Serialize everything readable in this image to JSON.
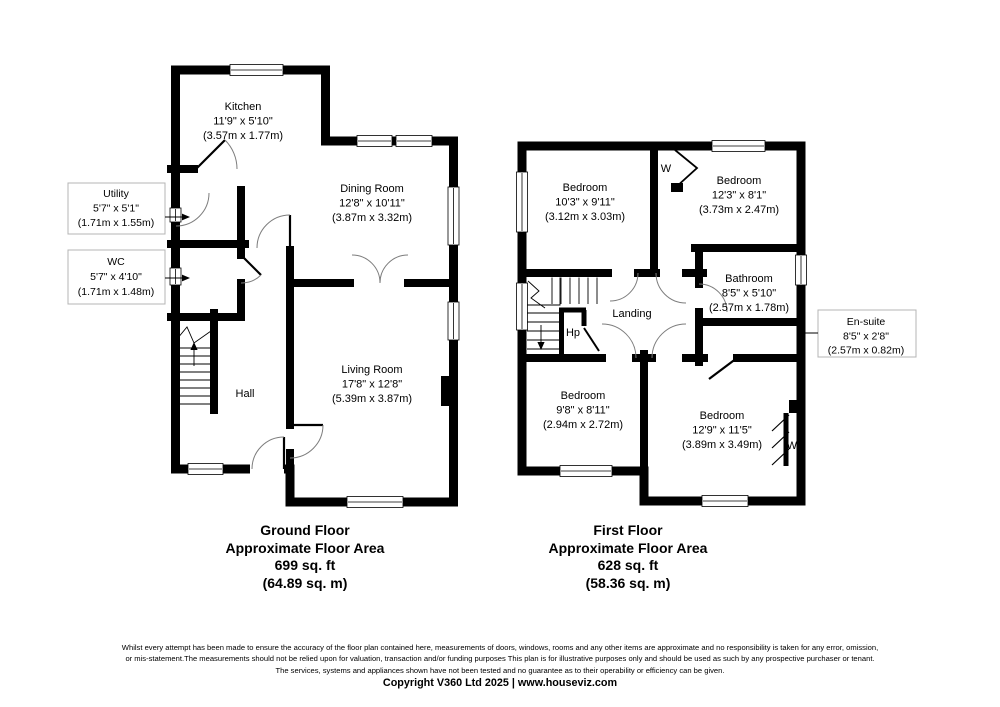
{
  "colors": {
    "wall": "#000000",
    "text": "#000000",
    "door_arc": "#7d7d7d",
    "callout_border": "#b4b4b4",
    "background": "#ffffff"
  },
  "ground_floor": {
    "rooms": {
      "kitchen": {
        "name": "Kitchen",
        "imperial": "11'9\" x 5'10\"",
        "metric": "(3.57m x 1.77m)"
      },
      "dining_room": {
        "name": "Dining Room",
        "imperial": "12'8\" x 10'11\"",
        "metric": "(3.87m x 3.32m)"
      },
      "living_room": {
        "name": "Living Room",
        "imperial": "17'8\" x 12'8\"",
        "metric": "(5.39m x 3.87m)"
      },
      "hall": {
        "name": "Hall"
      },
      "utility": {
        "name": "Utility",
        "imperial": "5'7\" x 5'1\"",
        "metric": "(1.71m x 1.55m)"
      },
      "wc": {
        "name": "WC",
        "imperial": "5'7\" x 4'10\"",
        "metric": "(1.71m x 1.48m)"
      }
    },
    "summary": {
      "title": "Ground Floor",
      "subtitle": "Approximate Floor Area",
      "area_imperial": "699 sq. ft",
      "area_metric": "(64.89 sq. m)"
    }
  },
  "first_floor": {
    "rooms": {
      "bedroom_1": {
        "name": "Bedroom",
        "imperial": "10'3\" x 9'11\"",
        "metric": "(3.12m x 3.03m)"
      },
      "bedroom_2": {
        "name": "Bedroom",
        "imperial": "12'3\" x 8'1\"",
        "metric": "(3.73m x 2.47m)"
      },
      "bathroom": {
        "name": "Bathroom",
        "imperial": "8'5\" x 5'10\"",
        "metric": "(2.57m x 1.78m)"
      },
      "en_suite": {
        "name": "En-suite",
        "imperial": "8'5\" x 2'8\"",
        "metric": "(2.57m x 0.82m)"
      },
      "landing": {
        "name": "Landing"
      },
      "hp": {
        "name": "Hp"
      },
      "bedroom_3": {
        "name": "Bedroom",
        "imperial": "9'8\" x 8'11\"",
        "metric": "(2.94m x 2.72m)"
      },
      "bedroom_4": {
        "name": "Bedroom",
        "imperial": "12'9\" x 11'5\"",
        "metric": "(3.89m x 3.49m)"
      },
      "wardrobe_top": {
        "name": "W"
      },
      "wardrobe_bottom": {
        "name": "W"
      }
    },
    "summary": {
      "title": "First Floor",
      "subtitle": "Approximate Floor Area",
      "area_imperial": "628 sq. ft",
      "area_metric": "(58.36 sq. m)"
    }
  },
  "footer": {
    "disclaimer_lines": [
      "Whilst every attempt has been made to ensure the accuracy of the floor plan contained here, measurements of doors, windows, rooms and any other items are approximate and no responsibility is taken for any error, omission,",
      "or mis-statement.The measurements should not be relied upon for valuation, transaction and/or funding purposes This plan is for illustrative purposes only and should be used as such by any prospective purchaser or tenant.",
      "The services, systems and appliances shown have not been tested and no guarantee as to their operability or efficiency can be given."
    ],
    "copyright": "Copyright V360 Ltd 2025 | www.houseviz.com"
  }
}
